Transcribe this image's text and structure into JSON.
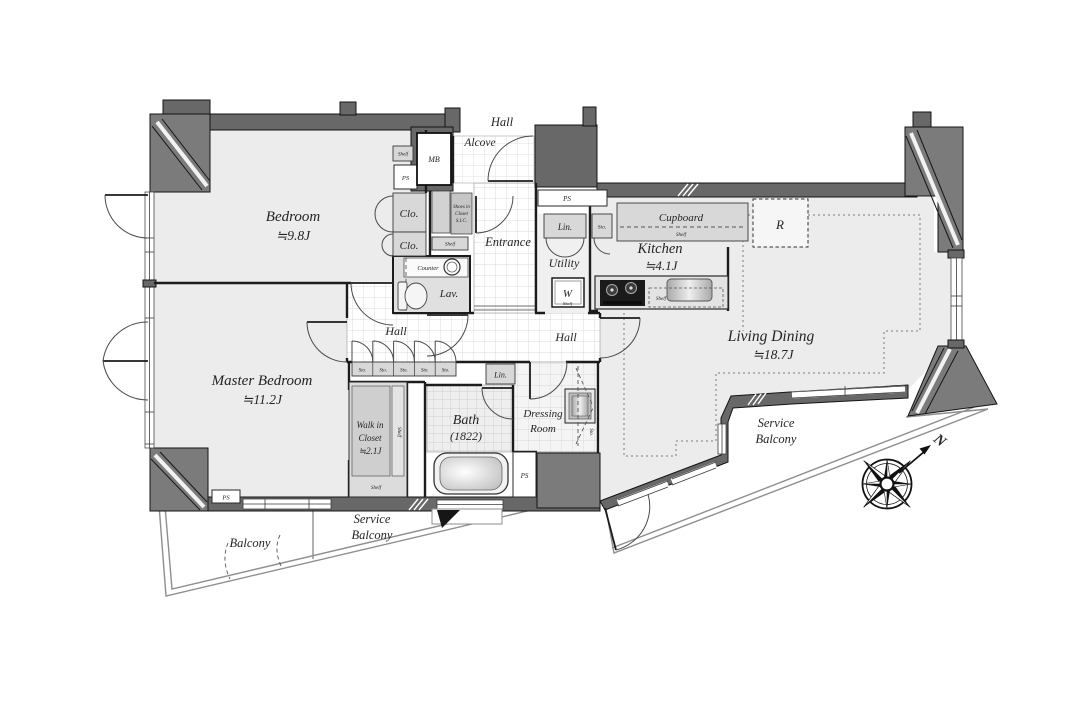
{
  "plan": {
    "corridor_top_label": "Hall",
    "compass": {
      "north": "N"
    },
    "rooms": {
      "bedroom": {
        "name": "Bedroom",
        "size": "≒9.8J"
      },
      "master": {
        "name": "Master Bedroom",
        "size": "≒11.2J"
      },
      "living": {
        "name": "Living Dining",
        "size": "≒18.7J"
      },
      "kitchen": {
        "name": "Kitchen",
        "size": "≒4.1J"
      },
      "wic": {
        "line1": "Walk in",
        "line2": "Closet",
        "size": "≒2.1J"
      },
      "bath": {
        "name": "Bath",
        "size": "(1822)"
      },
      "dressing": {
        "line1": "Dressing",
        "line2": "Room"
      },
      "entrance": "Entrance",
      "alcove": "Alcove",
      "utility": "Utility",
      "hall": "Hall",
      "balcony": "Balcony",
      "service_balcony": {
        "line1": "Service",
        "line2": "Balcony"
      }
    },
    "fixtures": {
      "clo": "Clo.",
      "mb": "MB",
      "ps": "PS",
      "shelf": "Shelf",
      "counter": "Counter",
      "lav": "Lav.",
      "lin": "Lin.",
      "sto": "Sto.",
      "cupboard": "Cupboard",
      "fridge": "R",
      "washer": "W",
      "shoes_closet": {
        "line1": "Shoes in",
        "line2": "Closet",
        "line3": "S.I.C."
      }
    },
    "colors": {
      "wall": "#686868",
      "pillar": "#7b7b7b",
      "room_fill": "#ececec",
      "fixture_fill": "#d8d8d8",
      "line": "#1c1c1c"
    }
  }
}
